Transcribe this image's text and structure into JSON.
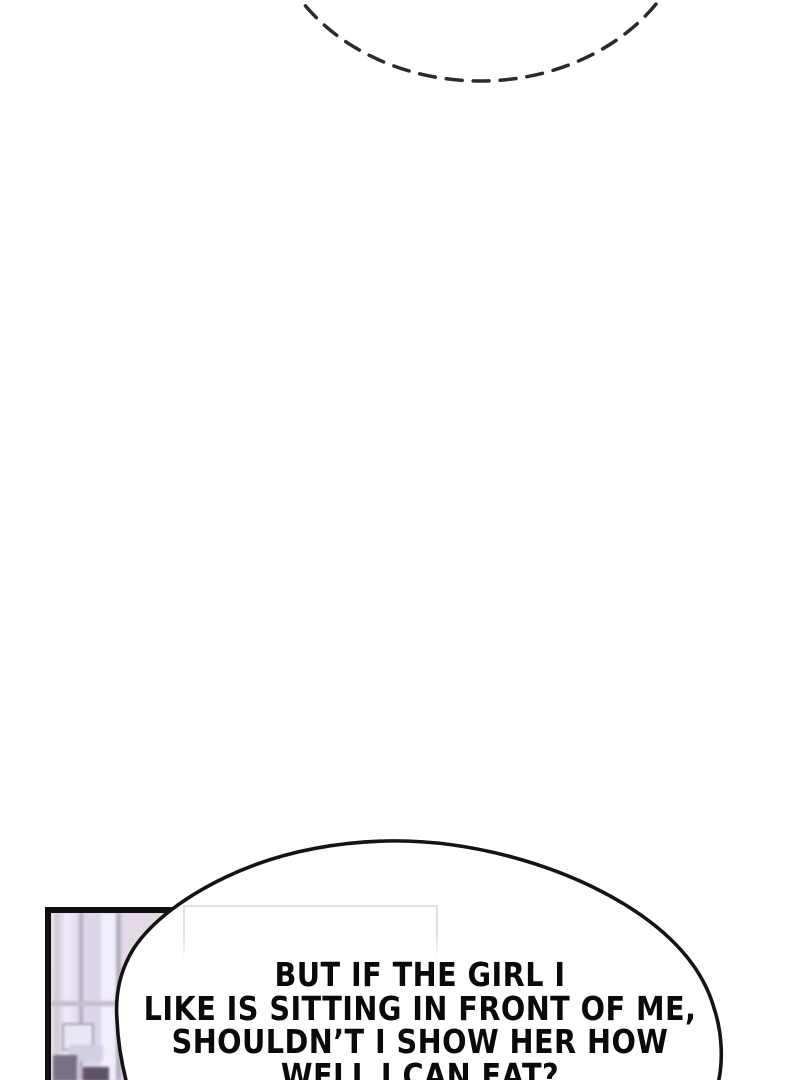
{
  "thought_bubble": {
    "stroke_color": "#2b2b2b"
  },
  "panel": {
    "border_color": "#101010",
    "background_color": "#dcd1de",
    "window_light": "#efebf7",
    "window_mid": "#dbd7e8",
    "window_frame": "#b5adc0",
    "shadow_dark": "#5e5366",
    "wall_frame_border": "#e0e0e0"
  },
  "speech_bubble": {
    "fill": "#ffffff",
    "stroke": "#141414",
    "lines": [
      "BUT IF THE GIRL I",
      "LIKE IS SITTING IN FRONT OF ME,",
      "SHOULDN’T I SHOW HER HOW",
      "WELL I CAN EAT?"
    ]
  }
}
